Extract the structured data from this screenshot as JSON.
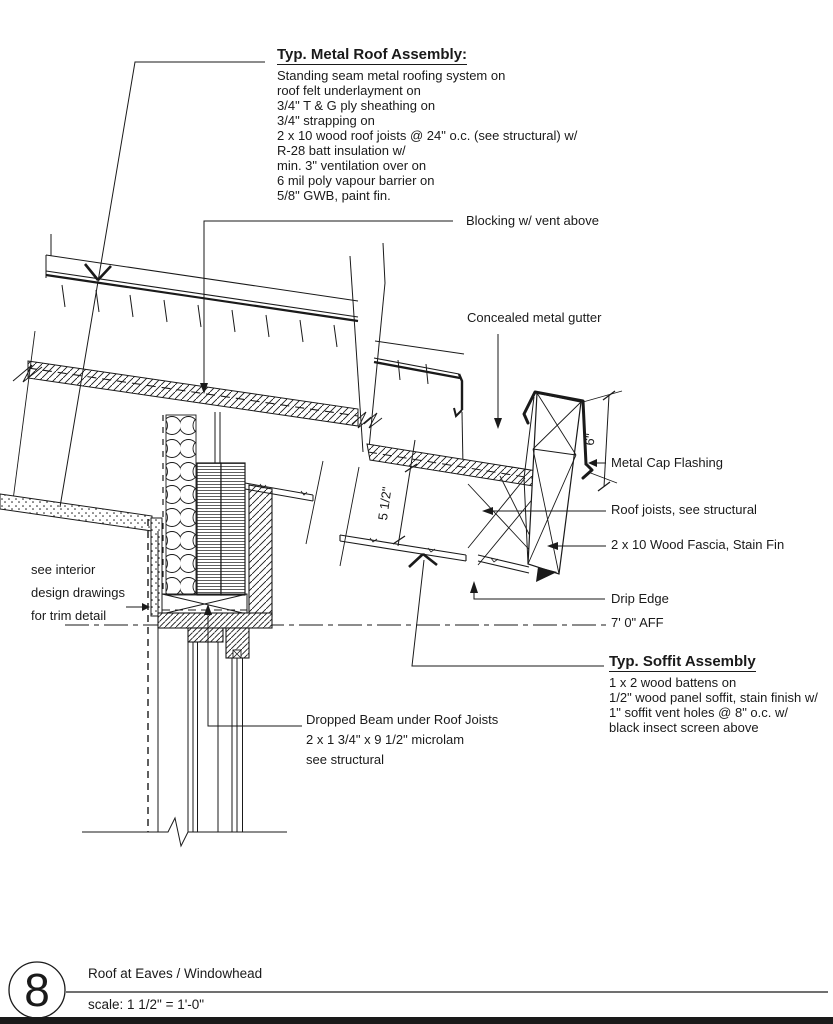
{
  "drawing": {
    "number": "8",
    "title": "Roof at Eaves / Windowhead",
    "scale": "scale: 1 1/2\" = 1'-0\""
  },
  "callouts": {
    "roof_assembly": {
      "title": "Typ. Metal Roof Assembly:",
      "lines": [
        "Standing seam metal roofing system on",
        "roof felt underlayment on",
        "3/4\" T & G ply sheathing on",
        "3/4\" strapping on",
        "2 x 10 wood roof joists @ 24\" o.c. (see structural) w/",
        "R-28 batt insulation w/",
        "min. 3\" ventilation over on",
        "6 mil poly vapour barrier on",
        "5/8\" GWB, paint fin."
      ]
    },
    "blocking": "Blocking w/ vent above",
    "gutter": "Concealed metal gutter",
    "cap_flashing": "Metal Cap Flashing",
    "roof_joists": "Roof joists, see structural",
    "fascia": "2 x 10 Wood Fascia, Stain Fin",
    "drip_edge": "Drip Edge",
    "aff_level": "7' 0\" AFF",
    "soffit_assembly": {
      "title": "Typ. Soffit Assembly",
      "lines": [
        "1 x 2 wood battens on",
        "1/2\" wood panel soffit, stain finish w/",
        "1\" soffit vent holes @ 8\" o.c. w/",
        "black insect screen above"
      ]
    },
    "interior_note": [
      "see interior",
      "design drawings",
      "for trim detail"
    ],
    "dropped_beam": [
      "Dropped Beam under Roof Joists",
      "2 x 1 3/4\" x 9 1/2\" microlam",
      "see structural"
    ],
    "dim_joist_depth": "5 1/2\"",
    "dim_fascia_height": "6\""
  },
  "colors": {
    "ink": "#1a1a1a",
    "paper": "#ffffff"
  }
}
